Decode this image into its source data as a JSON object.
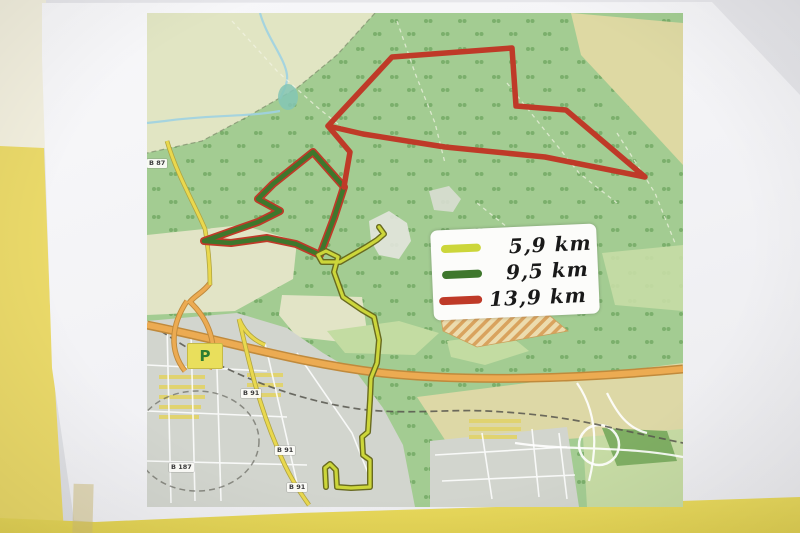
{
  "legend": {
    "items": [
      {
        "label": "5,9 km",
        "color": "#ccd63a"
      },
      {
        "label": "9,5 km",
        "color": "#3e772c"
      },
      {
        "label": "13,9 km",
        "color": "#bf3a28"
      }
    ]
  },
  "map": {
    "parking_label": "P",
    "road_labels": [
      {
        "text": "B 87"
      },
      {
        "text": "B 91"
      },
      {
        "text": "B 91"
      },
      {
        "text": "B 91"
      },
      {
        "text": "B 187"
      }
    ],
    "colors": {
      "forest": "#a3cc92",
      "open_land": "#e1e5c3",
      "farmland": "#ded9a3",
      "town": "#d2d5ce",
      "highway": "#ecab52",
      "water": "#9fd2e2"
    }
  }
}
